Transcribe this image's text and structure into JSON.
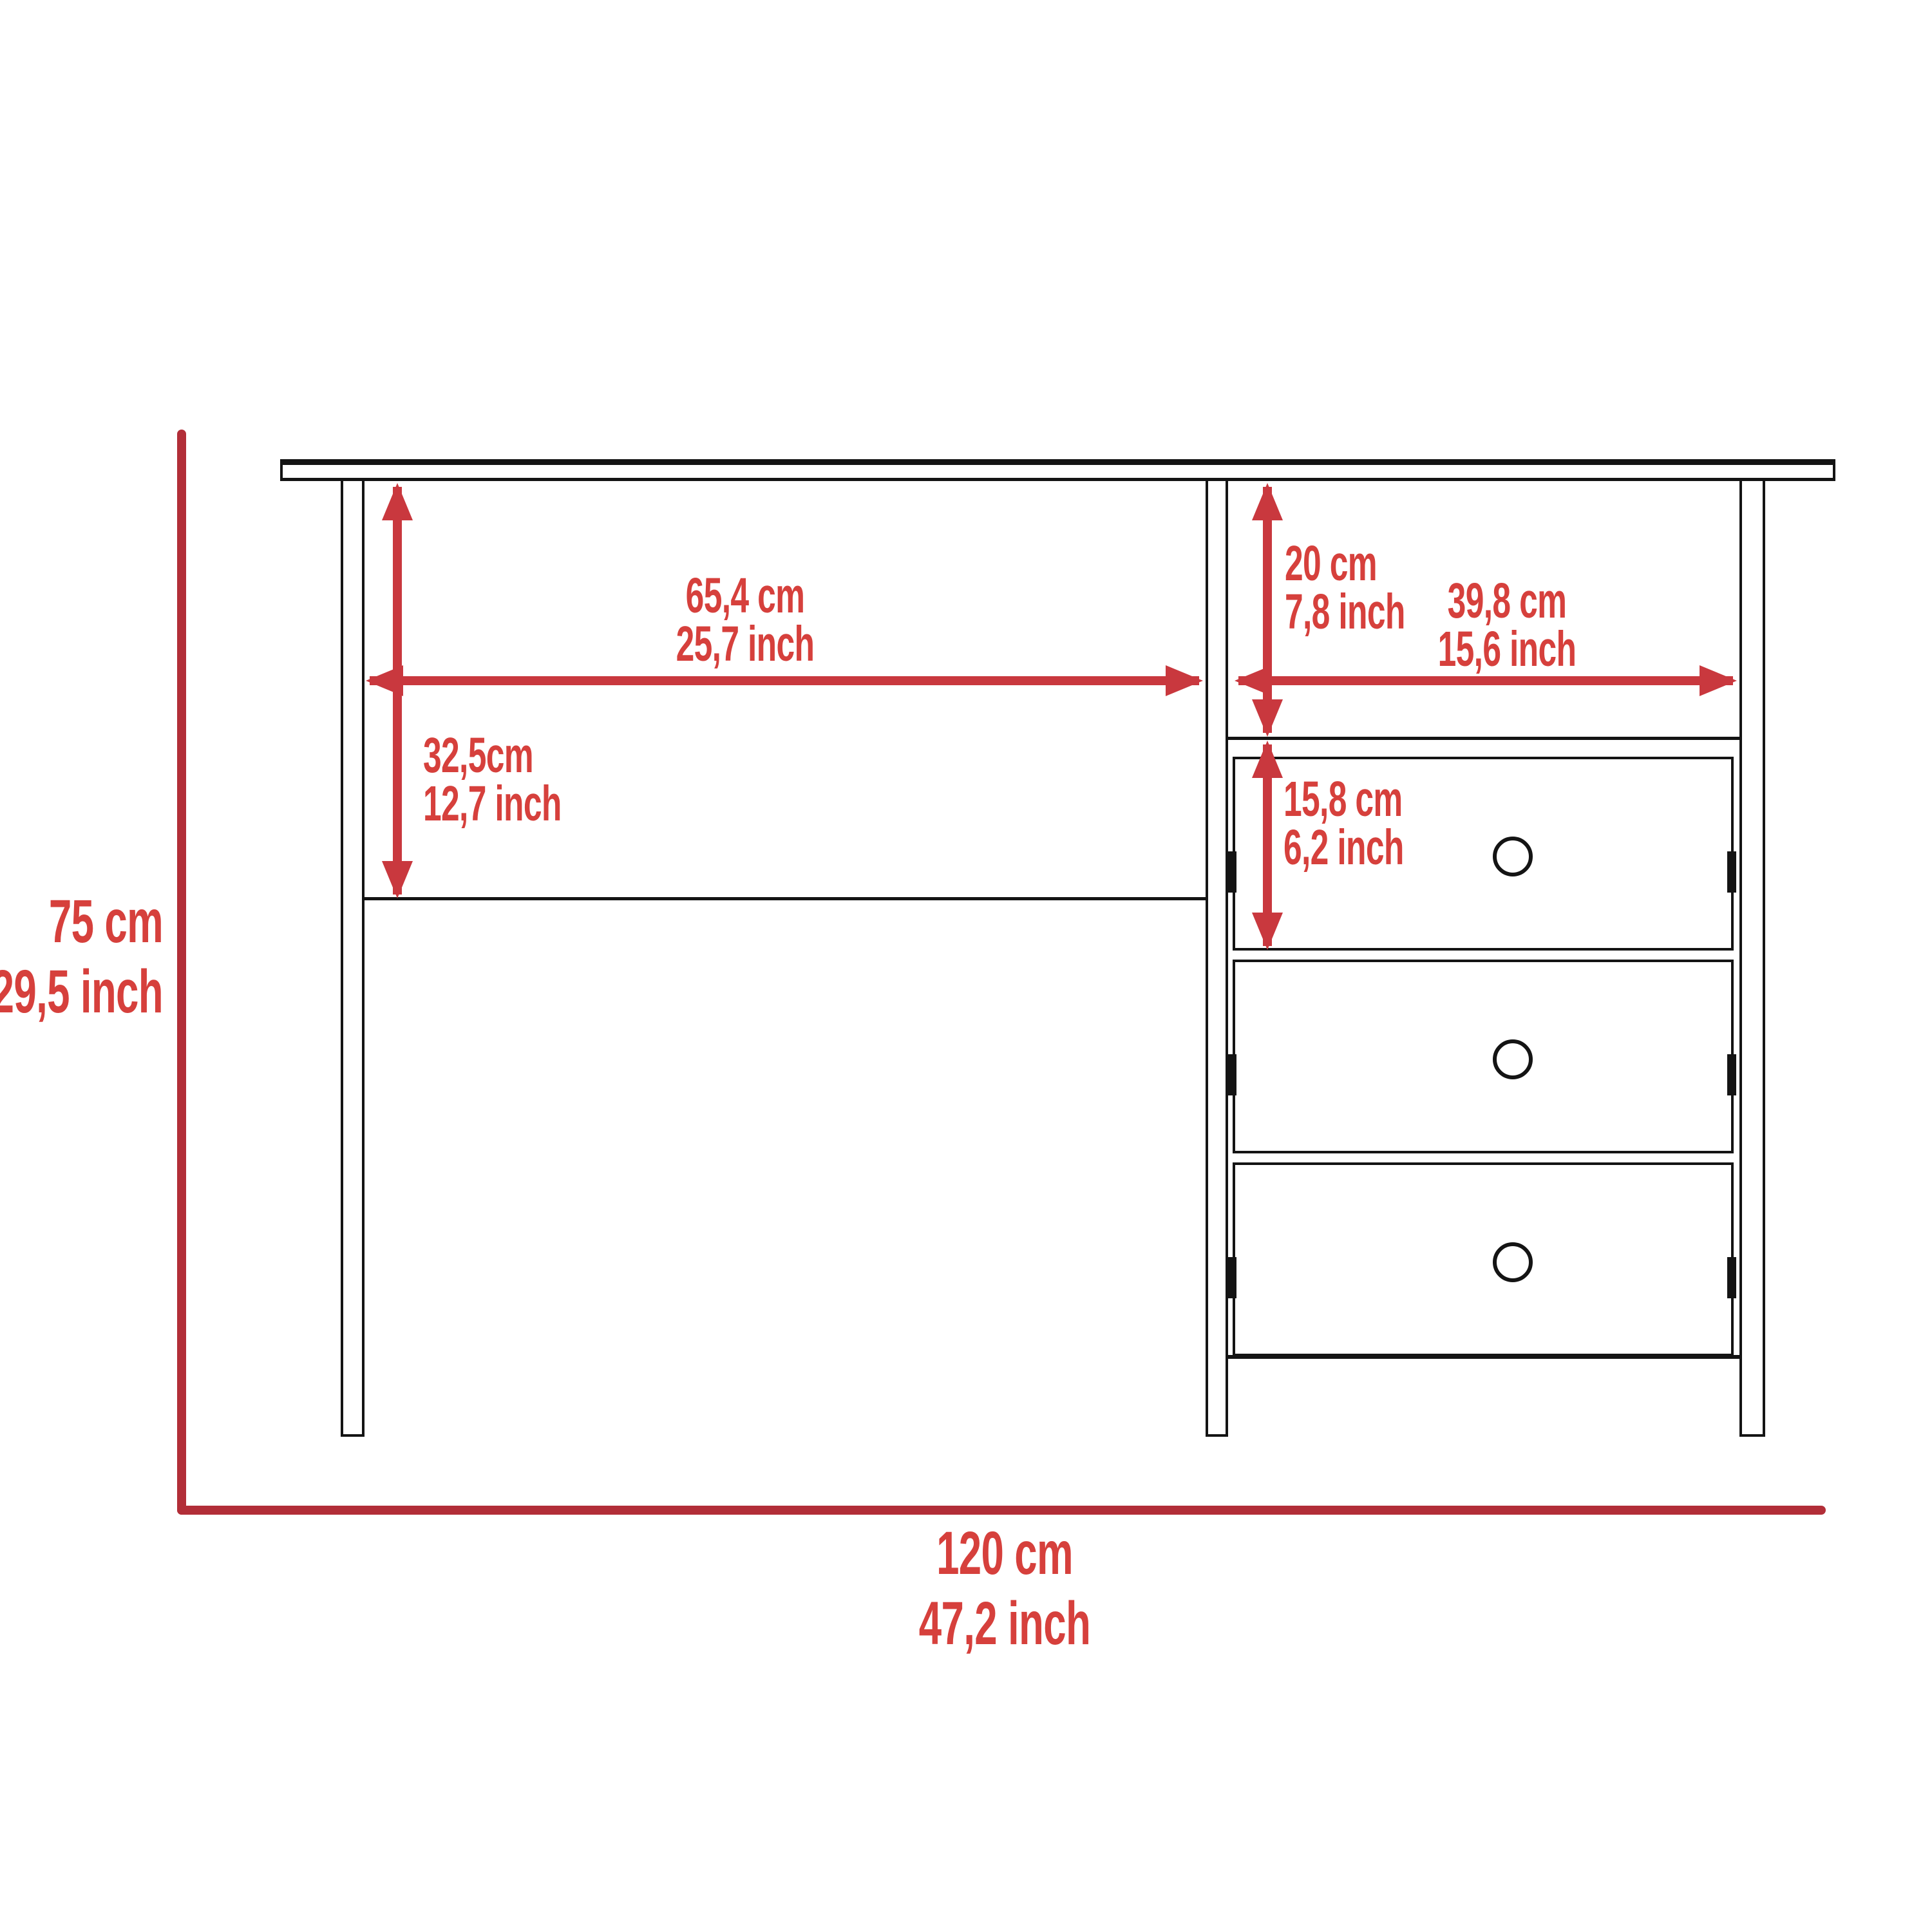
{
  "diagram": {
    "kind": "furniture-dimension-drawing",
    "item": "writing desk with three-drawer pedestal",
    "drawer_count": 3,
    "colors": {
      "outline": "#141414",
      "overall_dimension_line": "#b22e38",
      "arrow": "#c9383e",
      "label_text": "#d6403c",
      "background": "#ffffff"
    },
    "dims": {
      "knee_width": {
        "cm": "65,4 cm",
        "inch": "25,7 inch"
      },
      "back_panel_height": {
        "cm": "32,5cm",
        "inch": "12,7 inch"
      },
      "top_compartment_height": {
        "cm": "20 cm",
        "inch": "7,8 inch"
      },
      "pedestal_inner_width": {
        "cm": "39,8 cm",
        "inch": "15,6 inch"
      },
      "drawer_height": {
        "cm": "15,8 cm",
        "inch": "6,2 inch"
      },
      "overall_height": {
        "cm": "75 cm",
        "inch": "29,5 inch"
      },
      "overall_width": {
        "cm": "120 cm",
        "inch": "47,2 inch"
      }
    }
  }
}
